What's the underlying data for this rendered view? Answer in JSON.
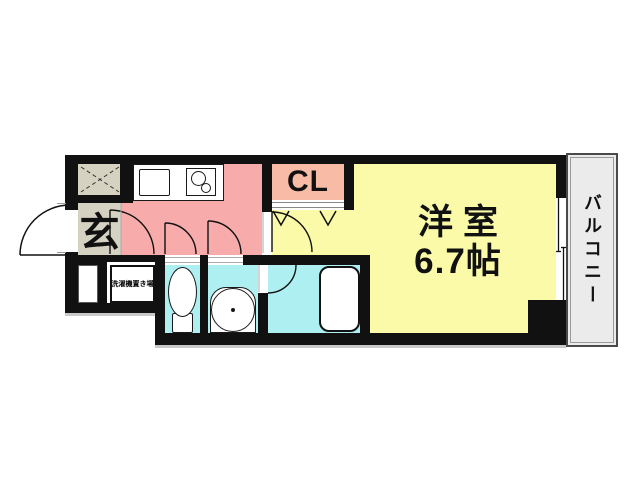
{
  "floorplan": {
    "type": "japanese-apartment-1K",
    "rooms": {
      "entrance": {
        "label": "玄"
      },
      "closet": {
        "label": "CL"
      },
      "western_room": {
        "name": "洋室",
        "size": "6.7帖"
      },
      "balcony": {
        "label": "バルコニー"
      },
      "laundry_space": {
        "label": "洗濯機置き場"
      }
    },
    "fixtures": [
      "shoe-storage-hatch",
      "kitchen-sink",
      "stove-two-burner",
      "toilet",
      "washbasin",
      "bathtub",
      "entrance-door",
      "sliding-window",
      "folding-closet-door"
    ],
    "colors": {
      "kitchen_hall": "#f7abab",
      "closet": "#f8bba6",
      "western_room": "#fafaa8",
      "wet_rooms": "#aef0f2",
      "entrance_floor": "#d6d2c2",
      "balcony": "#ebebeb",
      "walls": "#111111",
      "background": "#ffffff"
    }
  }
}
